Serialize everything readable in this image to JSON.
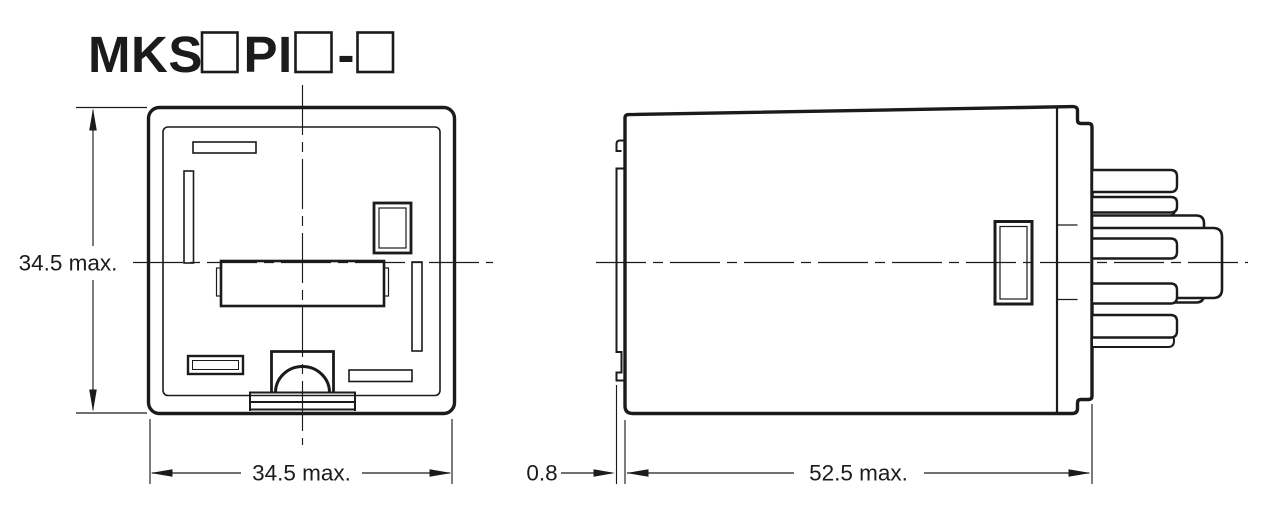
{
  "title": {
    "display": "MKS□PI□-□",
    "segments": {
      "prefix": "MKS",
      "infix": "PI",
      "separator": "-"
    }
  },
  "views": {
    "front": {
      "label": "front-view",
      "height_dim": "34.5 max.",
      "width_dim": "34.5 max."
    },
    "side": {
      "label": "side-view",
      "flange_dim": "0.8",
      "length_dim": "52.5 max."
    }
  },
  "colors": {
    "ink": "#1b1b1b",
    "background": "#ffffff"
  }
}
